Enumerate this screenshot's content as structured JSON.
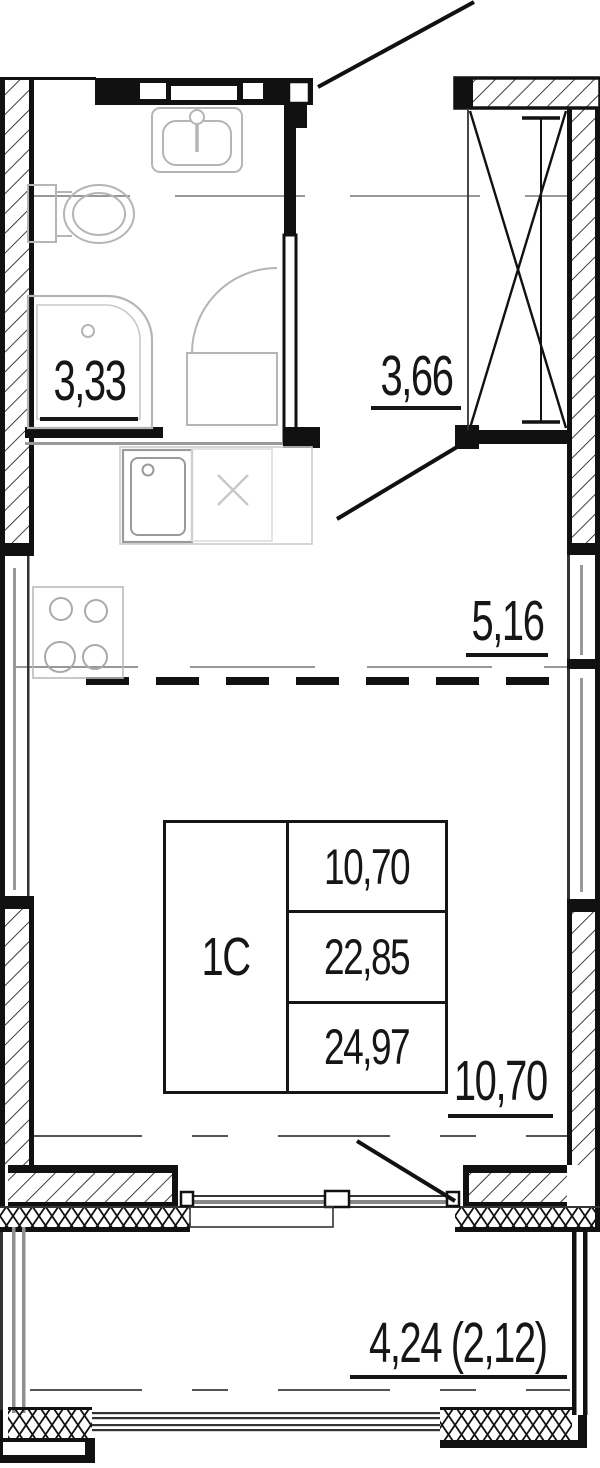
{
  "plan": {
    "unit_type_code": "1С",
    "areas": {
      "bathroom": "3,33",
      "hallway": "3,66",
      "kitchen": "5,16",
      "living_room": "10,70",
      "balcony": "4,24 (2,12)"
    },
    "info_table": {
      "unit_type": "1С",
      "living_area": "10,70",
      "area_no_balcony": "22,85",
      "total_area": "24,97"
    },
    "colors": {
      "line": "#111111",
      "fixture_outline": "#b5b5b5",
      "centerline": "#8a8a8a",
      "background": "#ffffff"
    }
  }
}
